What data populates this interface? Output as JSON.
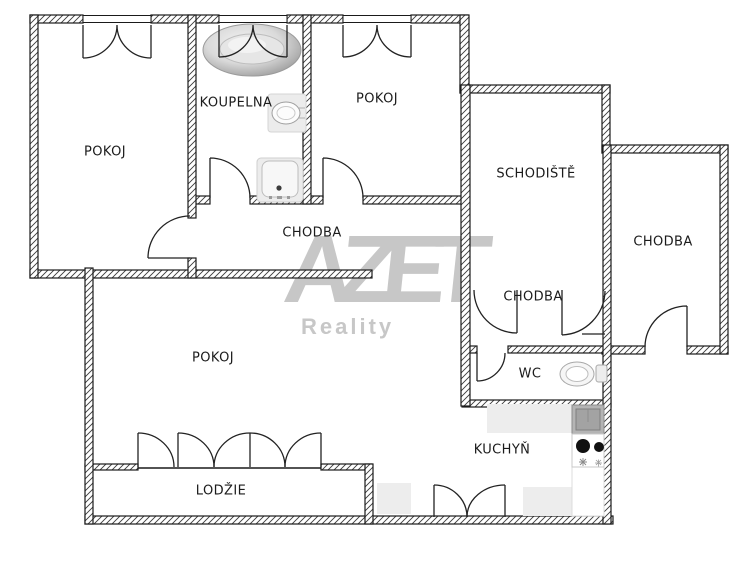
{
  "plan": {
    "watermark": {
      "brand": "AZET",
      "subtitle": "Reality",
      "color": "#c7c7c7"
    },
    "rooms": [
      {
        "id": "pokoj-top-left",
        "label": "POKOJ"
      },
      {
        "id": "koupelna",
        "label": "KOUPELNA"
      },
      {
        "id": "pokoj-top-middle",
        "label": "POKOJ"
      },
      {
        "id": "schodiste",
        "label": "SCHODIŠTĚ"
      },
      {
        "id": "chodba-right",
        "label": "CHODBA"
      },
      {
        "id": "chodba-middle",
        "label": "CHODBA"
      },
      {
        "id": "chodba-entry",
        "label": "CHODBA"
      },
      {
        "id": "pokoj-large",
        "label": "POKOJ"
      },
      {
        "id": "wc",
        "label": "WC"
      },
      {
        "id": "kuchyn",
        "label": "KUCHYŇ"
      },
      {
        "id": "lodzie",
        "label": "LODŽIE"
      }
    ],
    "fixtures": [
      "bathtub",
      "washbasin",
      "shower",
      "toilet",
      "kitchen-sink",
      "stove"
    ],
    "colors": {
      "wall_line": "#1a1a1a",
      "hatch": "#3a3a3a",
      "fixture_gray": "#ececec",
      "sink_gray": "#b4b4b4"
    }
  }
}
